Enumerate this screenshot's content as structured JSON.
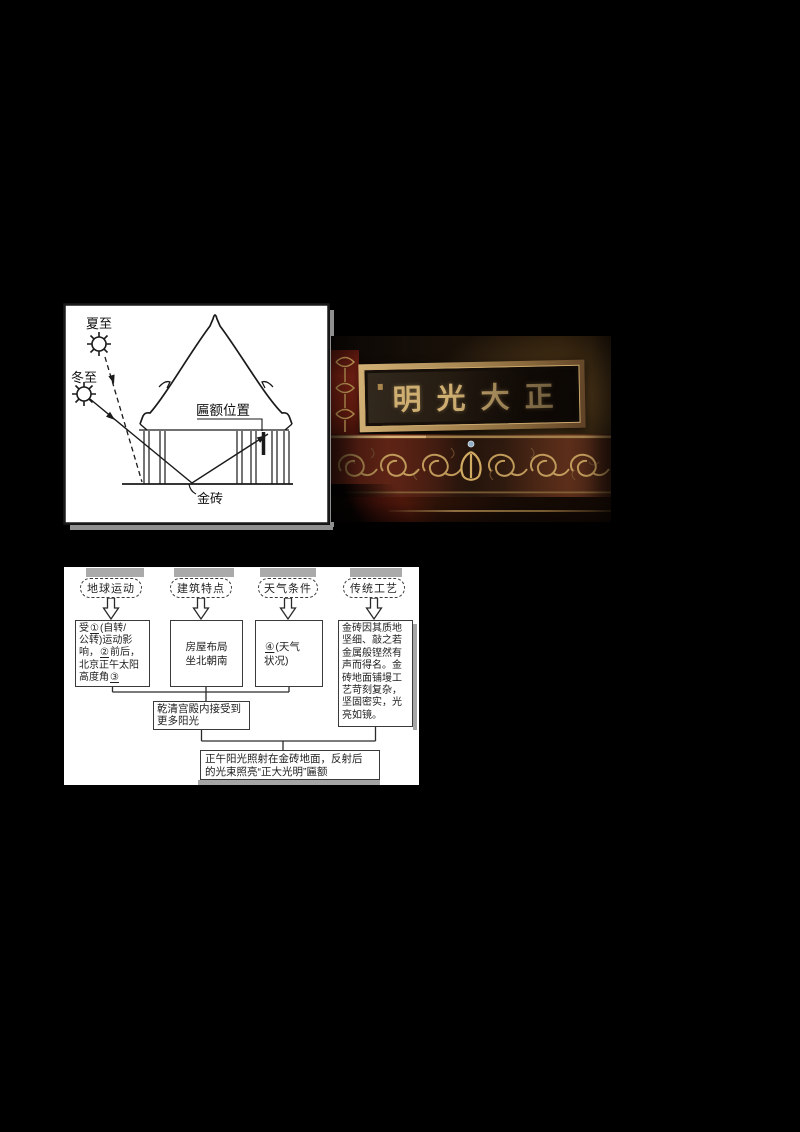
{
  "canvas": {
    "background": "#000000"
  },
  "diagram": {
    "labels": {
      "summer_solstice": "夏至",
      "winter_solstice": "冬至",
      "plaque_position": "匾额位置",
      "gold_brick": "金砖"
    }
  },
  "photo": {
    "plaque_display_text": "明光大正",
    "colors": {
      "frame_gold": "#b5945e",
      "character_gold": "#cfae72",
      "band_red": "#6f2518",
      "interior_dark": "#1c130c"
    }
  },
  "flowchart": {
    "category_boxes": [
      {
        "label": "地球运动"
      },
      {
        "label": "建筑特点"
      },
      {
        "label": "天气条件"
      },
      {
        "label": "传统工艺"
      }
    ],
    "earth_motion_box": {
      "lines": [
        {
          "pre": "受",
          "blank": "①",
          "post": "(自转/"
        },
        {
          "pre": "公转)运动影",
          "blank": "",
          "post": ""
        },
        {
          "pre": "响，",
          "blank": "②",
          "post": "前后，"
        },
        {
          "pre": "北京正午太阳",
          "blank": "",
          "post": ""
        },
        {
          "pre": "高度角",
          "blank": "③",
          "post": ""
        }
      ]
    },
    "building_box": {
      "lines": [
        "房屋布局",
        "坐北朝南"
      ]
    },
    "weather_box": {
      "lines": [
        {
          "pre": "",
          "blank": "④",
          "post": "(天气"
        },
        {
          "pre": "状况)",
          "blank": "",
          "post": ""
        }
      ]
    },
    "craft_box": {
      "lines": [
        "金砖因其质地",
        "坚细、敲之若",
        "金属般铿然有",
        "声而得名。金",
        "砖地面铺墁工",
        "艺苛刻复杂，",
        "坚固密实，光",
        "亮如镜。"
      ]
    },
    "mid_box": {
      "lines": [
        "乾清宫殿内接受到",
        "更多阳光"
      ]
    },
    "result_box": {
      "lines": [
        "正午阳光照射在金砖地面，反射后",
        "的光束照亮“正大光明”匾额"
      ]
    }
  }
}
